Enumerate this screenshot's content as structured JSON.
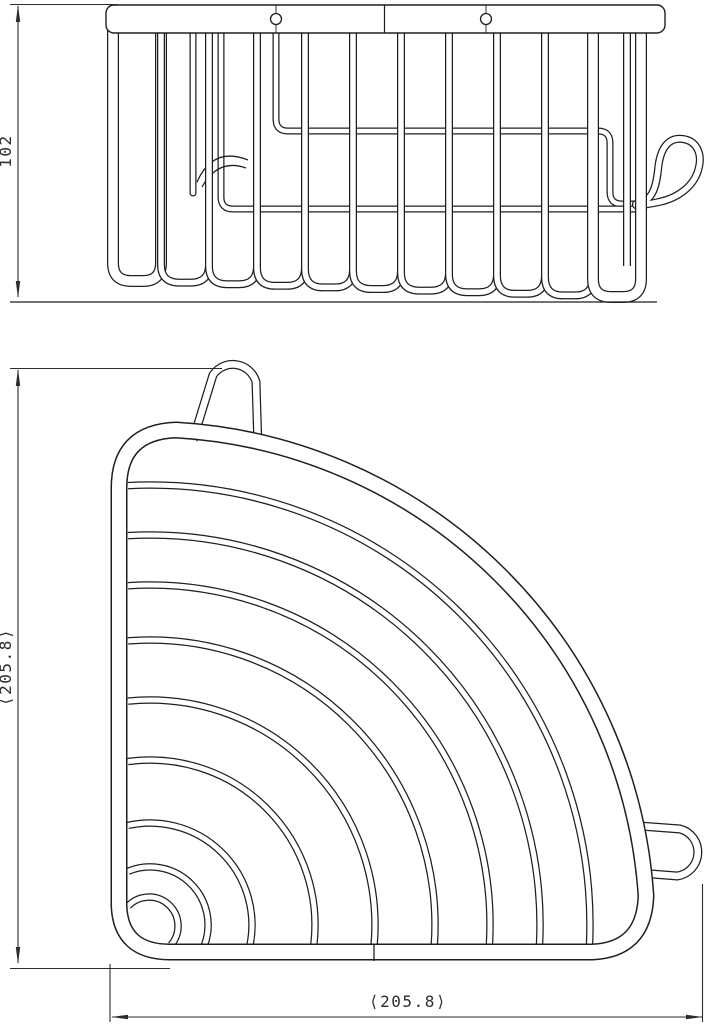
{
  "drawing": {
    "ink_color": "#1f1f1f",
    "dimension_color": "#2b2b2b",
    "background": "#ffffff"
  },
  "dimensions": {
    "side_height": "102",
    "plan_height": "⟨205.8⟩",
    "plan_width": "⟨205.8⟩"
  }
}
